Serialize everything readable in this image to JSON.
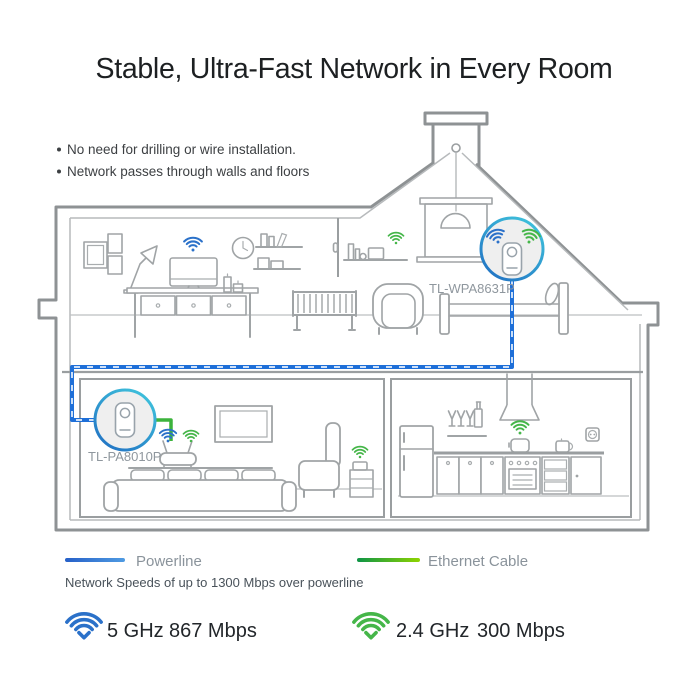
{
  "title": "Stable, Ultra-Fast Network in Every Room",
  "bullets": {
    "first": "No need for drilling or wire installation.",
    "second": "Network passes through walls and floors"
  },
  "adapters": {
    "upstairs": {
      "label": "TL-WPA8631P"
    },
    "downstairs": {
      "label": "TL-PA8010P"
    }
  },
  "legend": {
    "powerline_label": "Powerline",
    "powerline_note": "Network Speeds of up to 1300 Mbps over powerline",
    "ethernet_label": "Ethernet Cable"
  },
  "speeds": {
    "wifi5": {
      "band": "5 GHz",
      "rate": "867 Mbps"
    },
    "wifi24": {
      "band": "2.4 GHz",
      "rate": "300 Mbps"
    }
  },
  "colors": {
    "wifi_blue": "#2b71c9",
    "wifi_green": "#45b649",
    "powerline_blue": "#1e6fd8",
    "ethernet_green": "#3cb33c"
  }
}
